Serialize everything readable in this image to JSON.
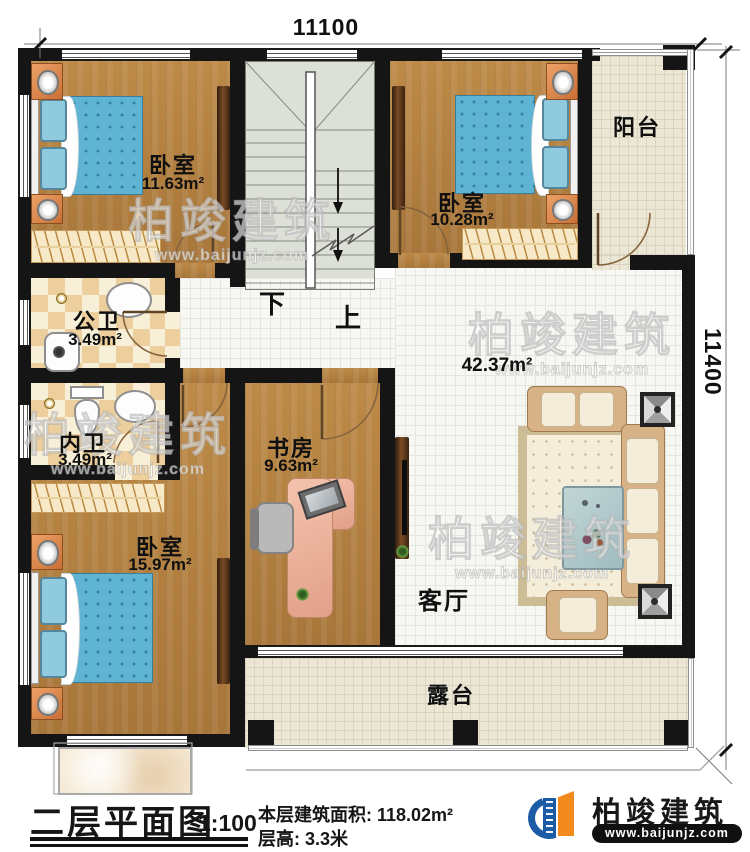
{
  "dimensions": {
    "top": "11100",
    "right": "11400"
  },
  "stairs": {
    "down": "下",
    "up": "上"
  },
  "rooms": {
    "bedroom_tl": {
      "name": "卧室",
      "area": "11.63m²"
    },
    "bedroom_tr": {
      "name": "卧室",
      "area": "10.28m²"
    },
    "balcony": {
      "name": "阳台"
    },
    "public_bath": {
      "name": "公卫",
      "area": "3.49m²"
    },
    "private_bath": {
      "name": "内卫",
      "area": "3.49m²"
    },
    "bedroom_bl": {
      "name": "卧室",
      "area": "15.97m²"
    },
    "study": {
      "name": "书房",
      "area": "9.63m²"
    },
    "living": {
      "name": "客厅",
      "area": "42.37m²"
    },
    "terrace": {
      "name": "露台"
    }
  },
  "watermark": {
    "brand": "柏竣建筑",
    "url": "www.baijunjz.com"
  },
  "footer": {
    "title": "二层平面图",
    "scale": "1:100",
    "info_line1": "本层建筑面积: 118.02m²",
    "info_line2": "层高: 3.3米",
    "brand": "柏竣建筑",
    "brand_url": "www.baijunjz.com"
  },
  "colors": {
    "wall": "#151515",
    "wood": "#b3803f",
    "tile": "#ebe7d4",
    "accent_blue": "#1c5ba6",
    "accent_orange": "#f28a1d",
    "bed_blue": "#5fb3d3"
  }
}
